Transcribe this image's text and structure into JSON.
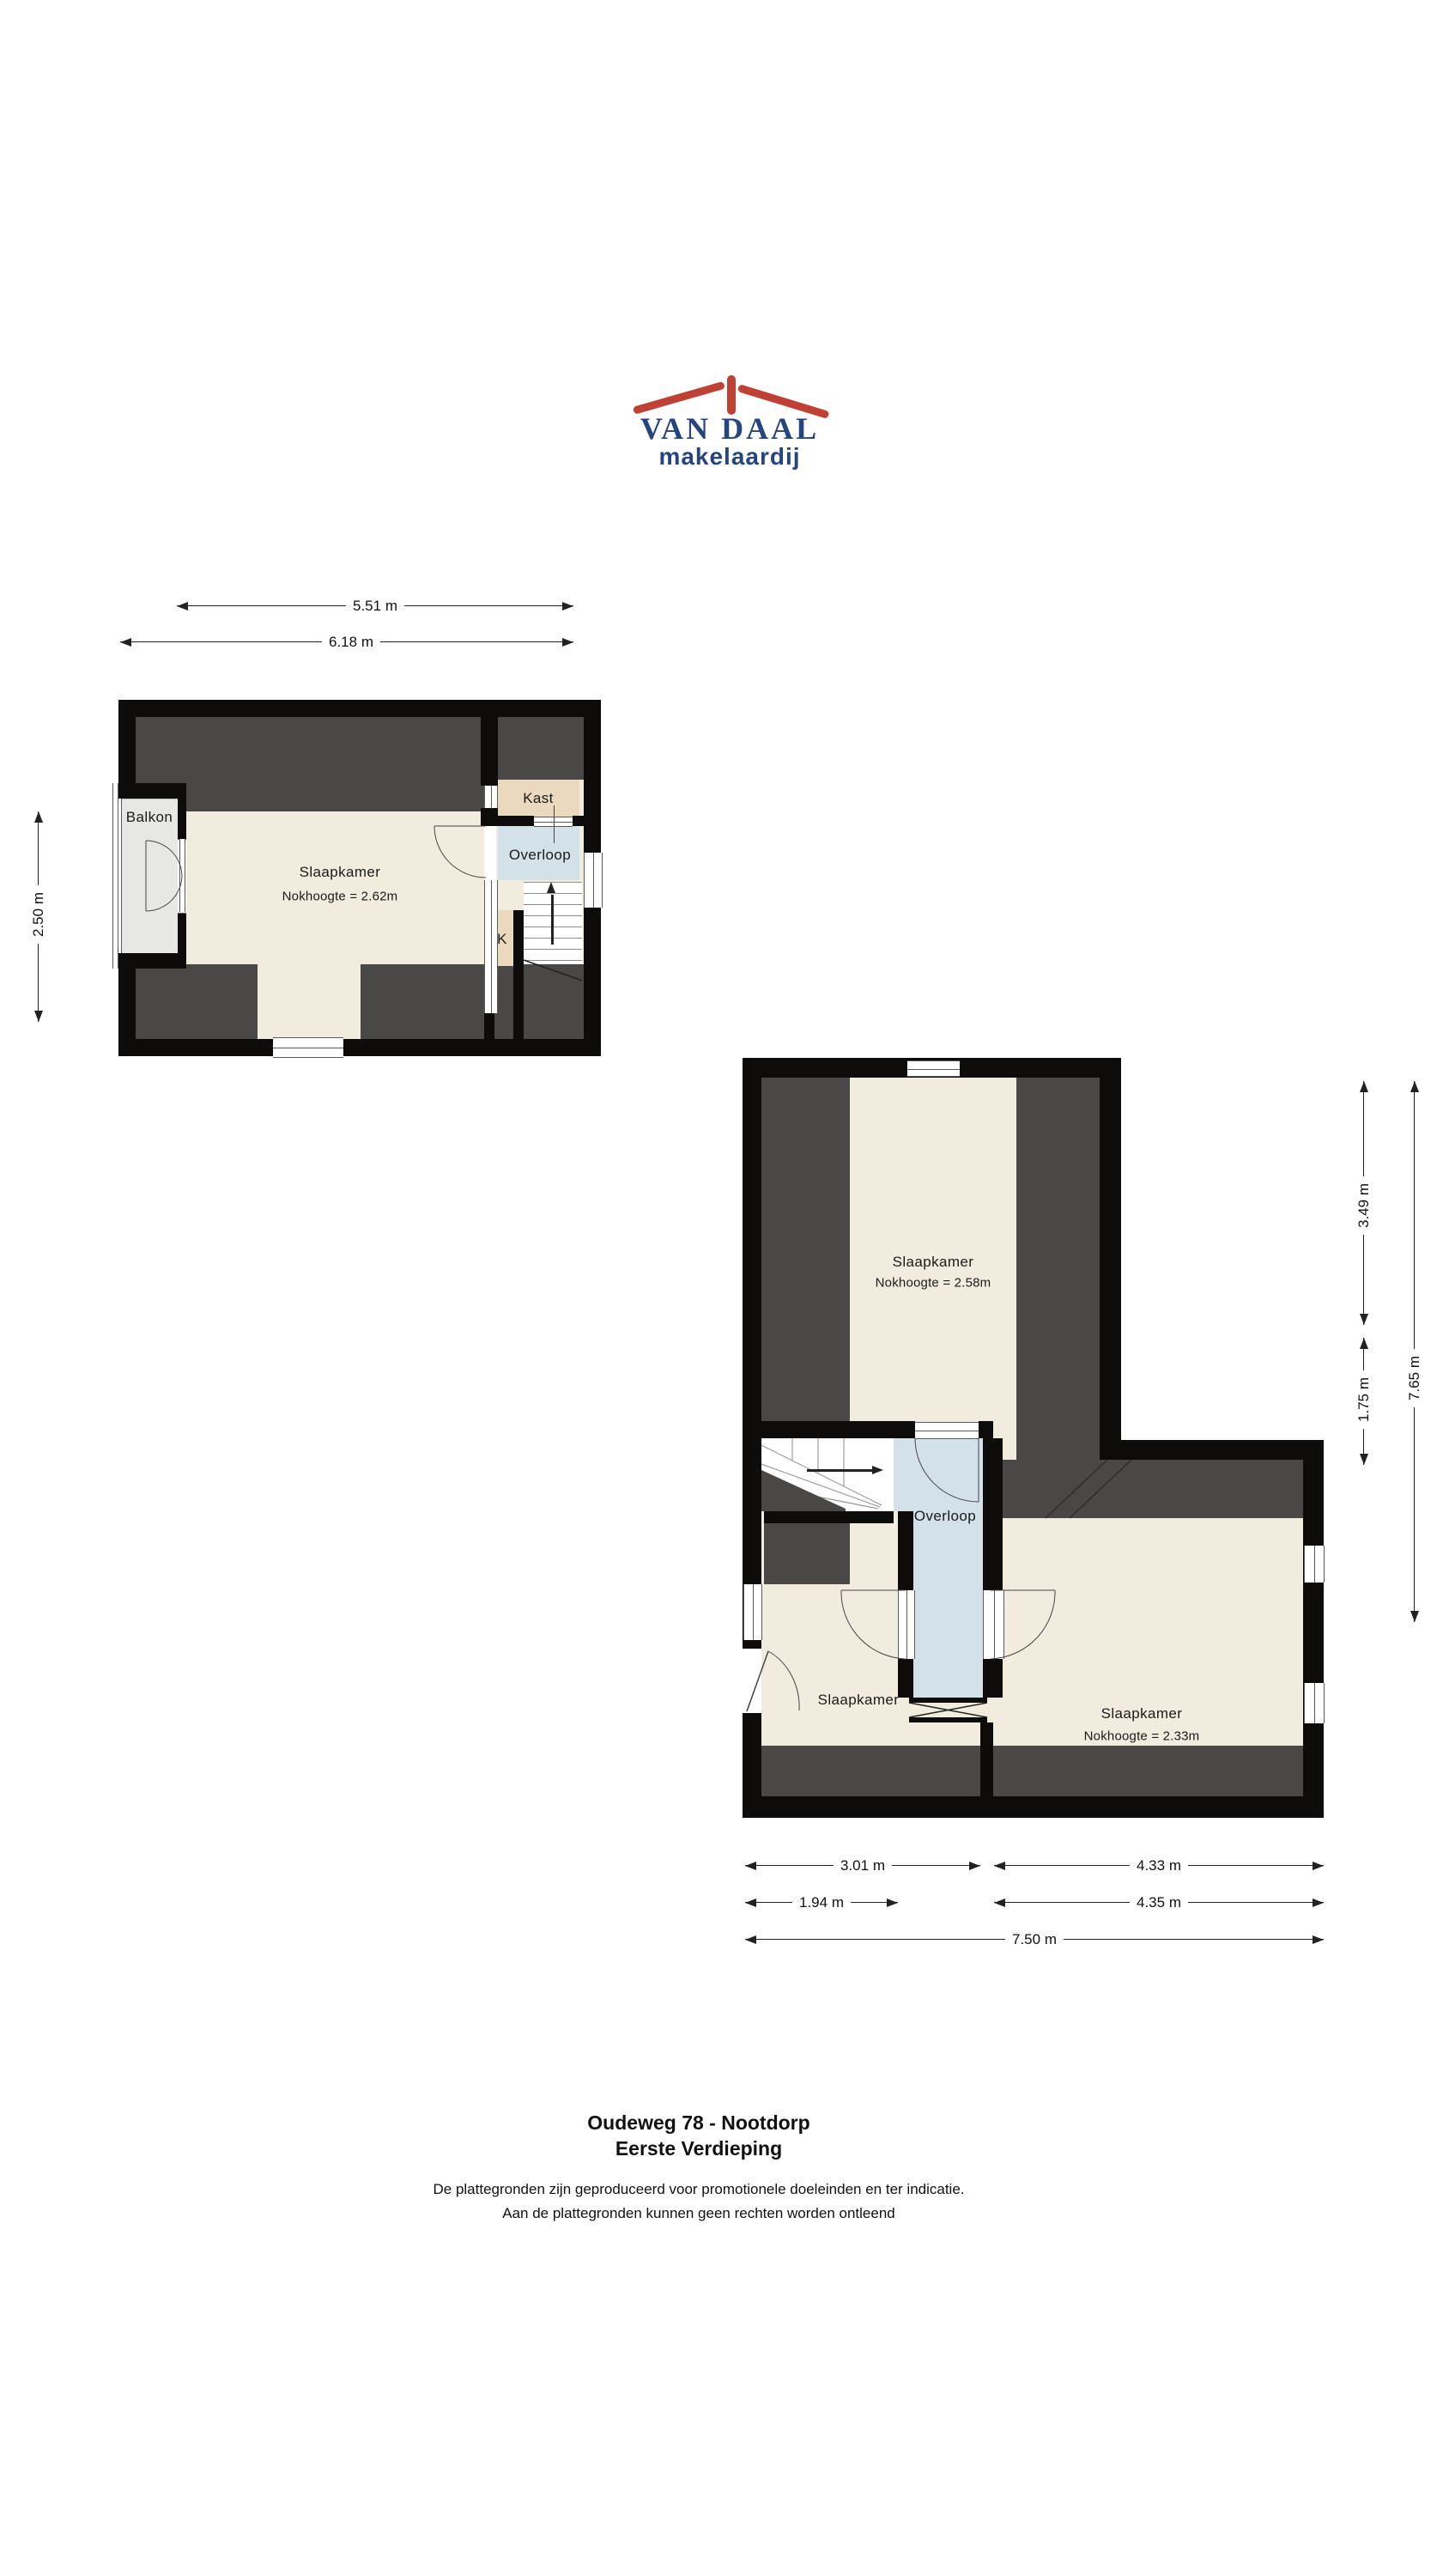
{
  "colors": {
    "brand_blue": "#26457f",
    "brand_red": "#bf4136",
    "wall_black": "#0d0c0a",
    "roof_gray": "#4a4847",
    "floor_cream": "#f2ecdf",
    "closet_beige": "#ead9bf",
    "hall_blue": "#d3e2e8",
    "balcony_gray": "#e7e7e5"
  },
  "logo": {
    "name": "VAN DAAL",
    "tagline": "makelaardij"
  },
  "first_plan": {
    "dim_width_top": "5.51 m",
    "dim_width_bottom": "6.18 m",
    "dim_depth_left": "2.50 m",
    "label_balkon": "Balkon",
    "label_slaapkamer": "Slaapkamer",
    "label_slaapkamer_note": "Nokhoogte = 2.62m",
    "label_kast": "Kast",
    "label_overloop": "Overloop",
    "label_k": "K"
  },
  "second_plan": {
    "dim_top_right": "3.49 m",
    "dim_mid_right": "1.75 m",
    "dim_full_right": "7.65 m",
    "dim_bottom_left1": "3.01 m",
    "dim_bottom_right1": "4.33 m",
    "dim_bottom_left2": "1.94 m",
    "dim_bottom_right2": "4.35 m",
    "dim_bottom_full": "7.50 m",
    "label_slaapkamer_top": "Slaapkamer",
    "label_slaapkamer_top_note": "Nokhoogte = 2.58m",
    "label_overloop": "Overloop",
    "label_slaapkamer_left": "Slaapkamer",
    "label_slaapkamer_right": "Slaapkamer",
    "label_slaapkamer_right_note": "Nokhoogte = 2.33m"
  },
  "footer": {
    "title": "Oudeweg 78 - Nootdorp",
    "subtitle": "Eerste Verdieping",
    "disclaimer_line1": "De plattegronden zijn geproduceerd voor promotionele doeleinden en ter indicatie.",
    "disclaimer_line2": "Aan de plattegronden kunnen geen rechten worden ontleend"
  }
}
